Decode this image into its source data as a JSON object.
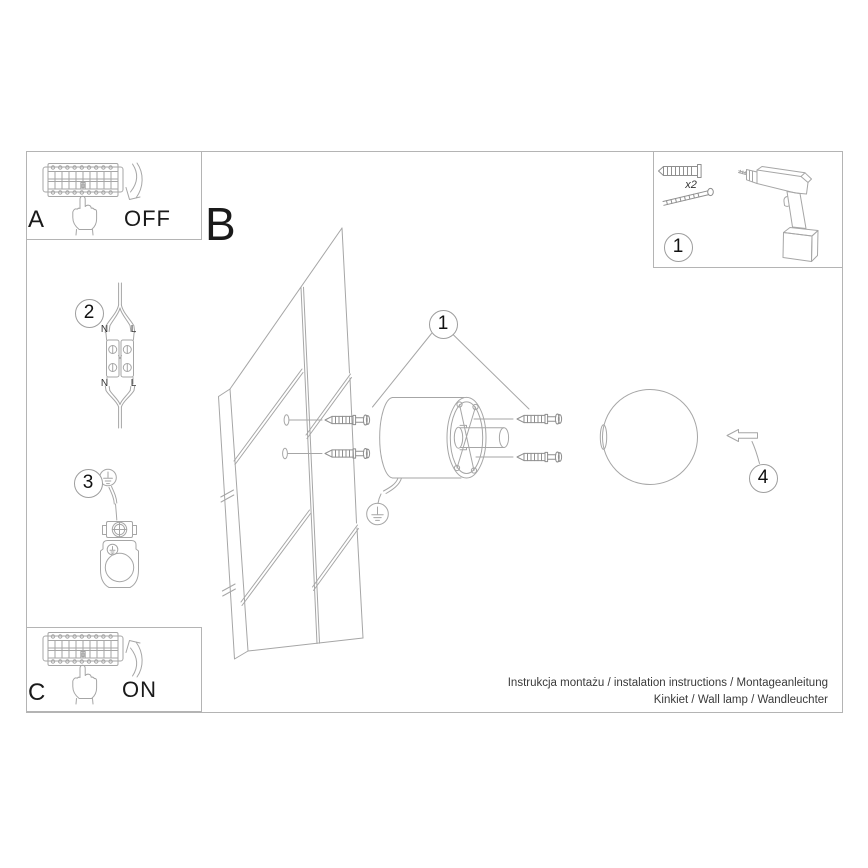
{
  "panels": {
    "power_off": {
      "letter": "A",
      "state_label": "OFF"
    },
    "power_on": {
      "letter": "C",
      "state_label": "ON"
    },
    "hardware_kit": {
      "callout": "1",
      "quantity_label": "x2"
    }
  },
  "main_diagram": {
    "letter": "B",
    "callout_hardware": "1",
    "callout_globe": "4"
  },
  "wiring_step": {
    "callout": "2",
    "terminal_labels": {
      "top_n": "N",
      "top_l": "L",
      "bottom_n": "N",
      "bottom_l": "L"
    }
  },
  "grounding_step": {
    "callout": "3"
  },
  "footer": {
    "line1": "Instrukcja montażu / instalation instructions / Montageanleitung",
    "line2": "Kinkiet / Wall lamp / Wandleuchter"
  },
  "colors": {
    "background": "#ffffff",
    "line_art": "#a6a6a6",
    "line_art_dark": "#8f8f8f",
    "frame_border": "#b4b4b4",
    "text_primary": "#1a1a1a",
    "footer_text": "#3a3a3a"
  }
}
